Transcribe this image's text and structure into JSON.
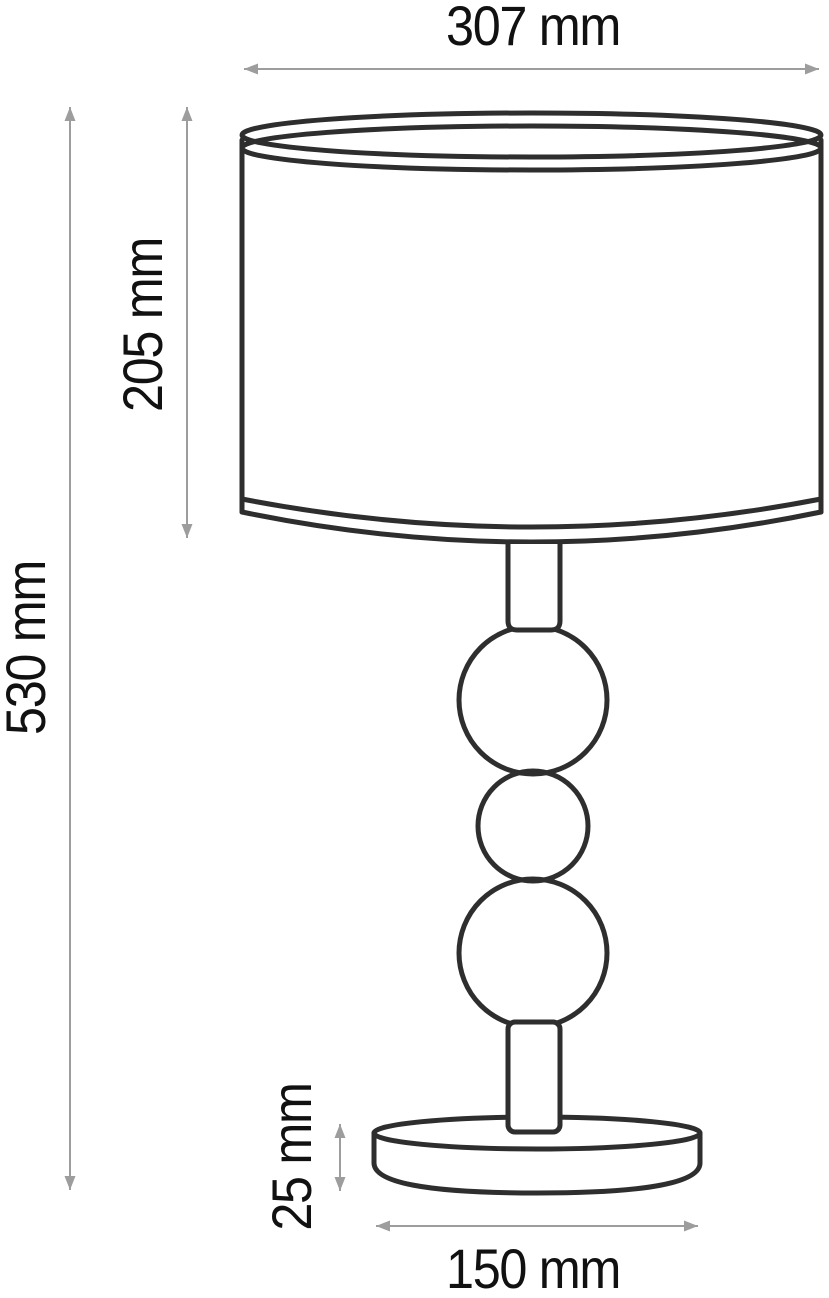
{
  "drawing": {
    "object": "table-lamp-technical-drawing",
    "labels": {
      "shade_width": "307 mm",
      "shade_height": "205 mm",
      "total_height": "530 mm",
      "base_height": "25 mm",
      "base_diameter": "150 mm"
    },
    "colors": {
      "outline": "#2e2e2e",
      "dimension_lines": "#9d9d9d",
      "label_text": "#111111",
      "background": "#ffffff"
    }
  }
}
